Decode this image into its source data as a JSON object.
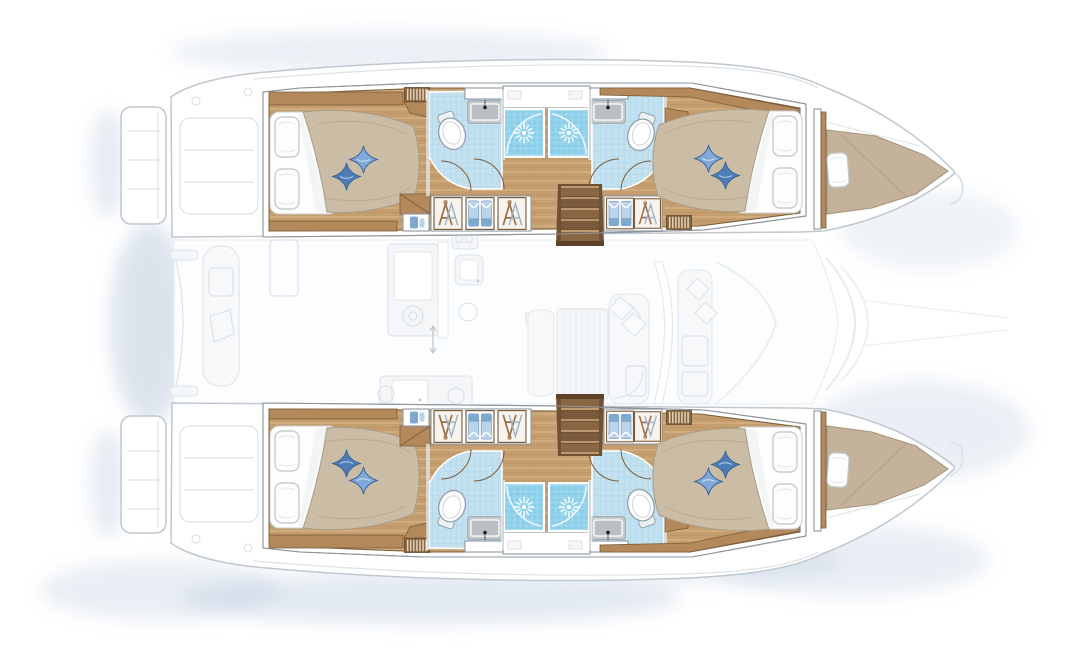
{
  "canvas": {
    "width": 1073,
    "height": 647
  },
  "colors": {
    "woodFloor": "#c59e70",
    "woodPlankLight": "#dcbd92",
    "woodPlankDark": "#b2895c",
    "woodMid": "#b3885a",
    "woodDark": "#7d5a38",
    "woodTrim": "#7d5c3b",
    "treadLight": "#cfa97c",
    "stepMid": "#8a6744",
    "stepDark": "#6f5233",
    "duvet": "#cabca5",
    "duvetShade": "#ab9d85",
    "cushionLight": "#7fa9d8",
    "cushionDark": "#4f7cb5",
    "cushionStroke": "#3d6396",
    "tile": "#c3e1ef",
    "tileGrid": "#9ecbdf",
    "shower": "#8ccfea",
    "showerGrid": "#c4e9f5",
    "fixtureGray": "#c9cdd0",
    "fixtureInner": "#b9bfc2",
    "toiletStroke": "#93a2ac",
    "pillowStroke": "#c6ccd1",
    "frameLine": "#8e979e",
    "hullLine": "#bfc7cf",
    "ghostFill": "#f4f6f8",
    "ghostLine": "#dde2e7",
    "shadow": "#b9c9dd",
    "hangerBrown": "#9b6c40",
    "hangerGray": "#9fb2c4",
    "clothesLight": "#bcd4ea",
    "clothesMid": "#7fa8d0",
    "forepeakPad": "#c4b29a",
    "forepeakShade": "#a6917a"
  },
  "plan": {
    "type": "yacht-floor-plan",
    "vessel": "sailing-catamaran",
    "view": "top-down-deck-plan",
    "orientation": "bow-right",
    "highlight": "lower-deck-accommodation",
    "hulls": [
      {
        "id": "port-hull",
        "position": "top",
        "cabins": [
          {
            "id": "port-aft-cabin",
            "berth": "double",
            "pillows": 2,
            "throw_cushions": 2
          },
          {
            "id": "port-forward-cabin",
            "berth": "double",
            "pillows": 2,
            "throw_cushions": 2
          }
        ],
        "bathrooms": [
          {
            "id": "port-aft-bathroom",
            "fixtures": [
              "washbasin",
              "toilet",
              "shower"
            ]
          },
          {
            "id": "port-forward-bathroom",
            "fixtures": [
              "washbasin",
              "toilet",
              "shower"
            ]
          }
        ],
        "features": [
          "companionway-stairs",
          "hanging-lockers",
          "linen-shelves",
          "vent-grilles",
          "forepeak-berth",
          "transom-platform"
        ]
      },
      {
        "id": "starboard-hull",
        "position": "bottom",
        "cabins": [
          {
            "id": "starboard-aft-cabin",
            "berth": "double",
            "pillows": 2,
            "throw_cushions": 2
          },
          {
            "id": "starboard-forward-cabin",
            "berth": "double",
            "pillows": 2,
            "throw_cushions": 2
          }
        ],
        "bathrooms": [
          {
            "id": "starboard-aft-bathroom",
            "fixtures": [
              "washbasin",
              "toilet",
              "shower"
            ]
          },
          {
            "id": "starboard-forward-bathroom",
            "fixtures": [
              "washbasin",
              "toilet",
              "shower"
            ]
          }
        ],
        "features": [
          "companionway-stairs",
          "hanging-lockers",
          "linen-shelves",
          "vent-grilles",
          "forepeak-berth",
          "transom-platform"
        ]
      }
    ],
    "bridgedeck": {
      "render_style": "ghosted",
      "zones": [
        {
          "id": "aft-cockpit",
          "features": [
            "bench-seat",
            "seat-cushion",
            "cockpit-table",
            "davits"
          ]
        },
        {
          "id": "saloon-galley",
          "features": [
            "galley-counter",
            "galley-sink",
            "stove-burners",
            "sliding-door"
          ]
        },
        {
          "id": "saloon-dining",
          "features": [
            "dining-table",
            "l-shaped-sofa",
            "scatter-cushions",
            "chaise",
            "mast-step"
          ]
        },
        {
          "id": "forward-cockpit",
          "features": [
            "windshield",
            "bench-seat",
            "scatter-cushions"
          ]
        },
        {
          "id": "foredeck",
          "features": [
            "trampoline-edges",
            "bridle-lines",
            "bow-wake-marks"
          ]
        }
      ]
    },
    "totals": {
      "cabins": 4,
      "bathrooms": 4,
      "showers": 4,
      "toilets": 4,
      "washbasins": 4,
      "companionways": 2
    }
  }
}
